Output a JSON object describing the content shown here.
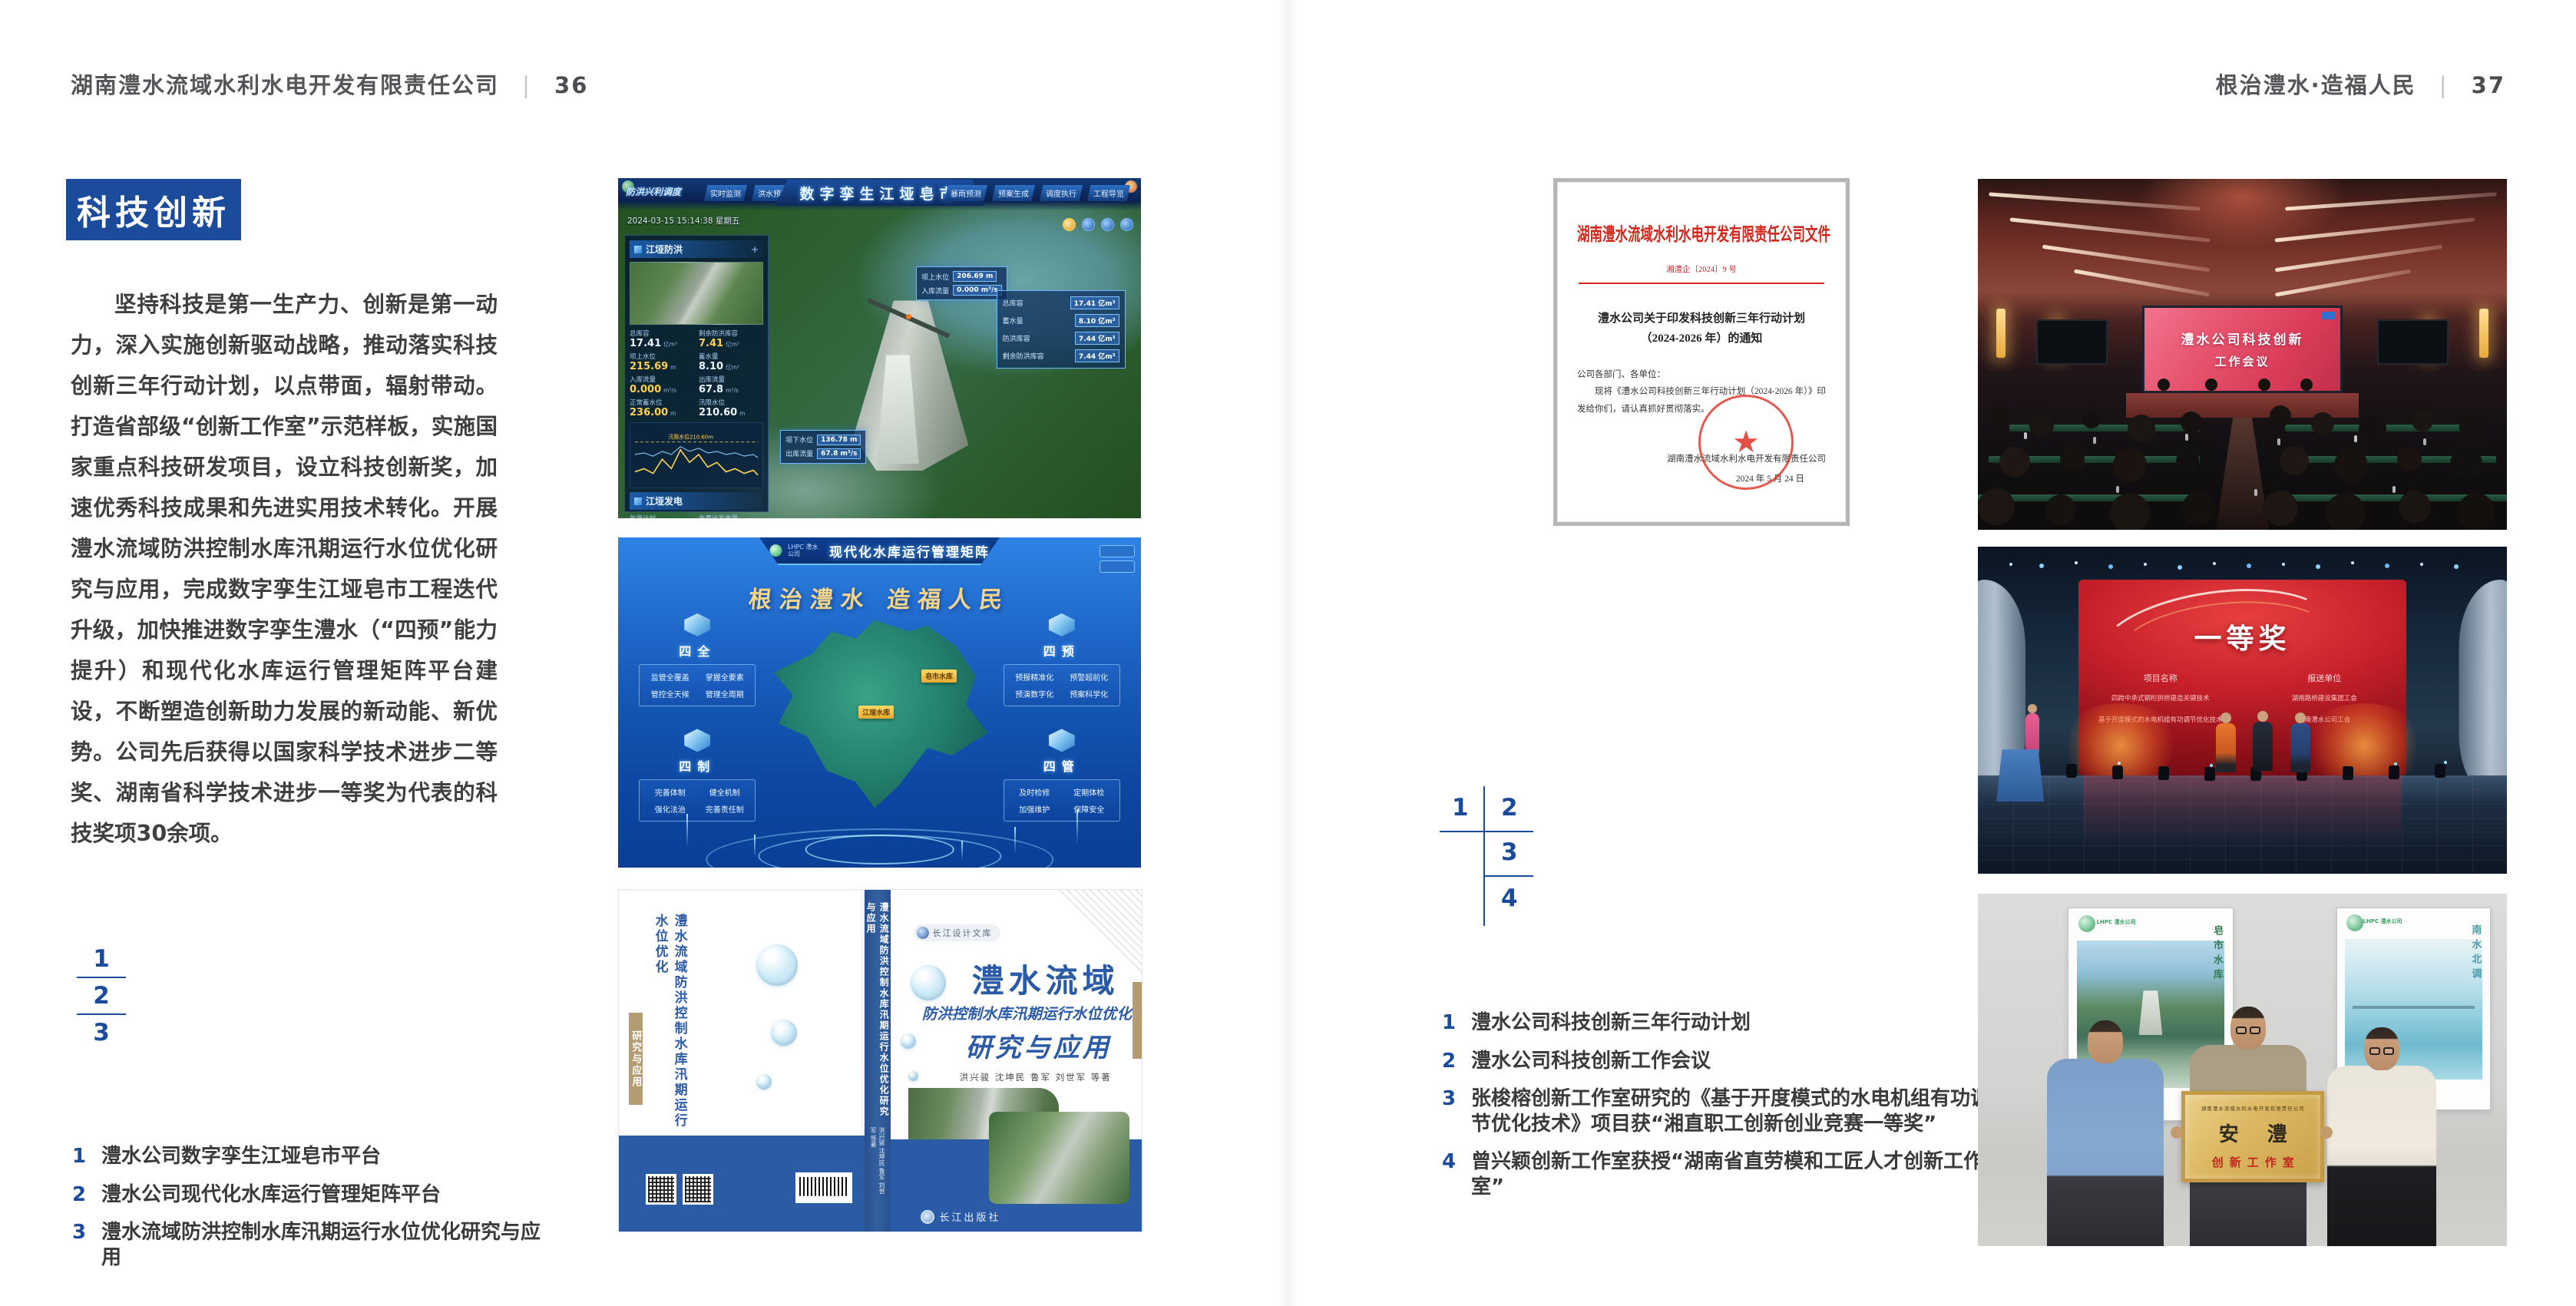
{
  "left_page": {
    "header": {
      "company": "湖南澧水流域水利水电开发有限责任公司",
      "divider": "|",
      "page_no": "36"
    },
    "section_title": "科技创新",
    "body_paragraph": "坚持科技是第一生产力、创新是第一动力，深入实施创新驱动战略，推动落实科技创新三年行动计划，以点带面，辐射带动。打造省部级“创新工作室”示范样板，实施国家重点科技研发项目，设立科技创新奖，加速优秀科技成果和先进实用技术转化。开展澧水流域防洪控制水库汛期运行水位优化研究与应用，完成数字孪生江垭皂市工程迭代升级，加快推进数字孪生澧水（“四预”能力提升）和现代化水库运行管理矩阵平台建设，不断塑造创新助力发展的新动能、新优势。公司先后获得以国家科学技术进步二等奖、湖南省科学技术进步一等奖为代表的科技奖项30余项。",
    "figure_index": [
      "1",
      "2",
      "3"
    ],
    "captions": [
      {
        "num": "1",
        "text": "澧水公司数字孪生江垭皂市平台"
      },
      {
        "num": "2",
        "text": "澧水公司现代化水库运行管理矩阵平台"
      },
      {
        "num": "3",
        "text": "澧水流域防洪控制水库汛期运行水位优化研究与应用"
      }
    ]
  },
  "right_page": {
    "header": {
      "title": "根治澧水·造福人民",
      "divider": "|",
      "page_no": "37"
    },
    "figure_index": [
      "1",
      "2",
      "3",
      "4"
    ],
    "captions": [
      {
        "num": "1",
        "text": "澧水公司科技创新三年行动计划"
      },
      {
        "num": "2",
        "text": "澧水公司科技创新工作会议"
      },
      {
        "num": "3",
        "text": "张梭榕创新工作室研究的《基于开度模式的水电机组有功调节优化技术》项目获“湘直职工创新创业竞赛一等奖”"
      },
      {
        "num": "4",
        "text": "曾兴颖创新工作室获授“湖南省直劳模和工匠人才创新工作室”"
      }
    ]
  },
  "figures": {
    "digital_twin": {
      "title": "数字孪生江垭皂市",
      "mode_label": "防洪兴利调度",
      "tabs_left": [
        "实时监测",
        "洪水预报",
        "防洪预警"
      ],
      "tabs_right": [
        "暴雨预测",
        "预案生成",
        "调度执行",
        "工程导览"
      ],
      "datetime": "2024-03-15 15:14:38 星期五",
      "panel1_title": "江垭防洪",
      "p1": [
        {
          "l": "总库容",
          "v": "17.41",
          "u": "亿m³"
        },
        {
          "l": "剩余防洪库容",
          "v": "7.41",
          "u": "亿m³"
        },
        {
          "l": "坝上水位",
          "v": "215.69",
          "u": "m"
        },
        {
          "l": "蓄水量",
          "v": "8.10",
          "u": "亿m³"
        },
        {
          "l": "入库流量",
          "v": "0.000",
          "u": "m³/s"
        },
        {
          "l": "出库流量",
          "v": "67.8",
          "u": "m³/s"
        },
        {
          "l": "正常蓄水位",
          "v": "236.00",
          "u": "m"
        },
        {
          "l": "汛限水位",
          "v": "210.60",
          "u": "m"
        }
      ],
      "chart_note": "汛限水位210.60m",
      "panel2_title": "江垭发电",
      "p2": [
        {
          "l": "年度计划",
          "v": "6.3000",
          "u": "亿度"
        },
        {
          "l": "年累计发电量",
          "v": "1.2907",
          "u": "亿度"
        },
        {
          "l": "月累计发电量",
          "v": "3359.21",
          "u": "万度"
        },
        {
          "l": "当前出力",
          "v": "0.00",
          "u": "MW"
        },
        {
          "l": "发电流量",
          "v": "0.00",
          "u": "m³/s"
        },
        {
          "l": "弃水流量",
          "v": "0.00",
          "u": "m³/s"
        }
      ],
      "tag_upper": [
        {
          "l": "坝上水位",
          "v": "206.69 m"
        },
        {
          "l": "入库流量",
          "v": "0.000 m³/s"
        }
      ],
      "side_panel": [
        {
          "l": "总库容",
          "v": "17.41 亿m³"
        },
        {
          "l": "蓄水量",
          "v": "8.10 亿m³"
        },
        {
          "l": "防洪库容",
          "v": "7.44 亿m³"
        },
        {
          "l": "剩余防洪库容",
          "v": "7.44 亿m³"
        }
      ],
      "tag_lower": [
        {
          "l": "坝下水位",
          "v": "136.78 m"
        },
        {
          "l": "出库流量",
          "v": "67.8 m³/s"
        }
      ]
    },
    "matrix": {
      "logo_text": "LHPC 澧水公司",
      "title": "现代化水库运行管理矩阵",
      "slogan": "根治澧水 造福人民",
      "map_labels": [
        "江垭水库",
        "皂市水库"
      ],
      "groups": [
        {
          "name": "四全",
          "items": [
            "监管全覆盖",
            "掌握全要素",
            "管控全天候",
            "管理全周期"
          ]
        },
        {
          "name": "四预",
          "items": [
            "预报精准化",
            "预警超前化",
            "预演数字化",
            "预案科学化"
          ]
        },
        {
          "name": "四制",
          "items": [
            "完善体制",
            "健全机制",
            "强化法治",
            "完善责任制"
          ]
        },
        {
          "name": "四管",
          "items": [
            "及时检修",
            "定期体检",
            "加强维护",
            "保障安全"
          ]
        }
      ]
    },
    "book": {
      "series_badge": "长江设计文库",
      "title_line1": "澧水流域",
      "title_line2": "防洪控制水库汛期运行水位优化",
      "title_line3": "研究与应用",
      "authors": "洪兴骏 沈坤民 鲁军 刘世军 等著",
      "back_title": "澧水流域防洪控制水库汛期运行水位优化",
      "back_sub": "研究与应用",
      "spine_text": "澧水流域防洪控制水库汛期运行水位优化研究与应用",
      "spine_authors": "洪兴骏 沈坤民 鲁军 刘世军 等著",
      "publisher": "长江出版社"
    },
    "document": {
      "header": "湖南澧水流域水利水电开发有限责任公司文件",
      "doc_no": "湘澧企〔2024〕9 号",
      "title": "澧水公司关于印发科技创新三年行动计划（2024-2026 年）的通知",
      "salutation": "公司各部门、各单位：",
      "body": "现将《澧水公司科技创新三年行动计划（2024-2026 年）》印发给你们，请认真抓好贯彻落实。",
      "signer": "湖南澧水流域水利水电开发有限责任公司",
      "date": "2024 年 5 月 24 日",
      "star": "★"
    },
    "meeting": {
      "screen_line1": "澧水公司科技创新",
      "screen_line2": "工作会议"
    },
    "award": {
      "headline": "一等奖",
      "col1": "项目名称",
      "col2": "报送单位",
      "rows": [
        {
          "project": "四跨中承式钢桁拱桥建造关键技术",
          "org": "湖南路桥建设集团工会"
        },
        {
          "project": "基于开度模式的水电机组有功调节优化技术",
          "org": "湖南澧水公司工会"
        }
      ]
    },
    "plaque": {
      "poster_logo": "LHPC 澧水公司",
      "poster_left_text": "皂市水库",
      "poster_right_text": "南水北调",
      "plaque_top": "湖南澧水流域水利水电开发有限责任公司",
      "plaque_main": "安 澧",
      "plaque_sub": "创新工作室"
    }
  },
  "colors": {
    "accent_blue": "#1d4b9b",
    "doc_red": "#d3281e"
  }
}
